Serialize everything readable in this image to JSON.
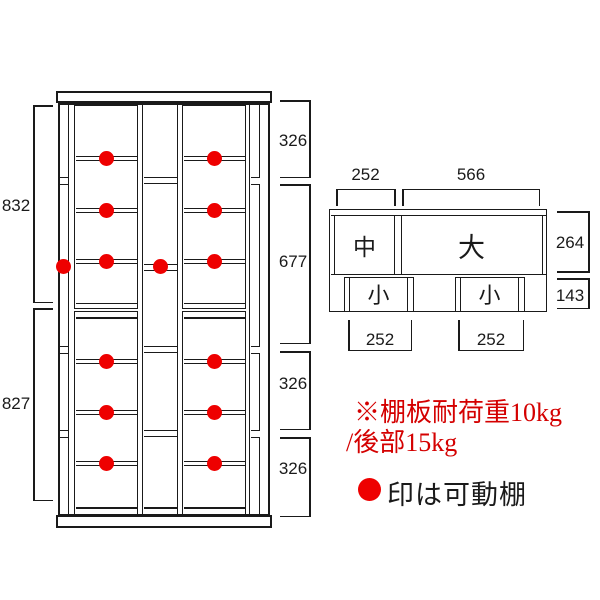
{
  "front_view": {
    "left_dimensions": [
      "832",
      "827"
    ],
    "right_dimensions": [
      "326",
      "677",
      "326",
      "326"
    ],
    "movable_shelf_marker_color": "#ee0000",
    "line_color": "#1a1a1a"
  },
  "top_view": {
    "section_labels": {
      "medium": "中",
      "large": "大",
      "small_left": "小",
      "small_right": "小"
    },
    "dimensions": {
      "top_left_width": "252",
      "top_right_width": "566",
      "upper_height": "264",
      "lower_height": "143",
      "bottom_left_width": "252",
      "bottom_right_width": "252"
    }
  },
  "notes": {
    "load_capacity_line1": "※棚板耐荷重10kg",
    "load_capacity_line2": "/後部15kg",
    "load_note_color": "#d40000",
    "legend_text": "印は可動棚",
    "legend_marker_color": "#ee0000"
  }
}
